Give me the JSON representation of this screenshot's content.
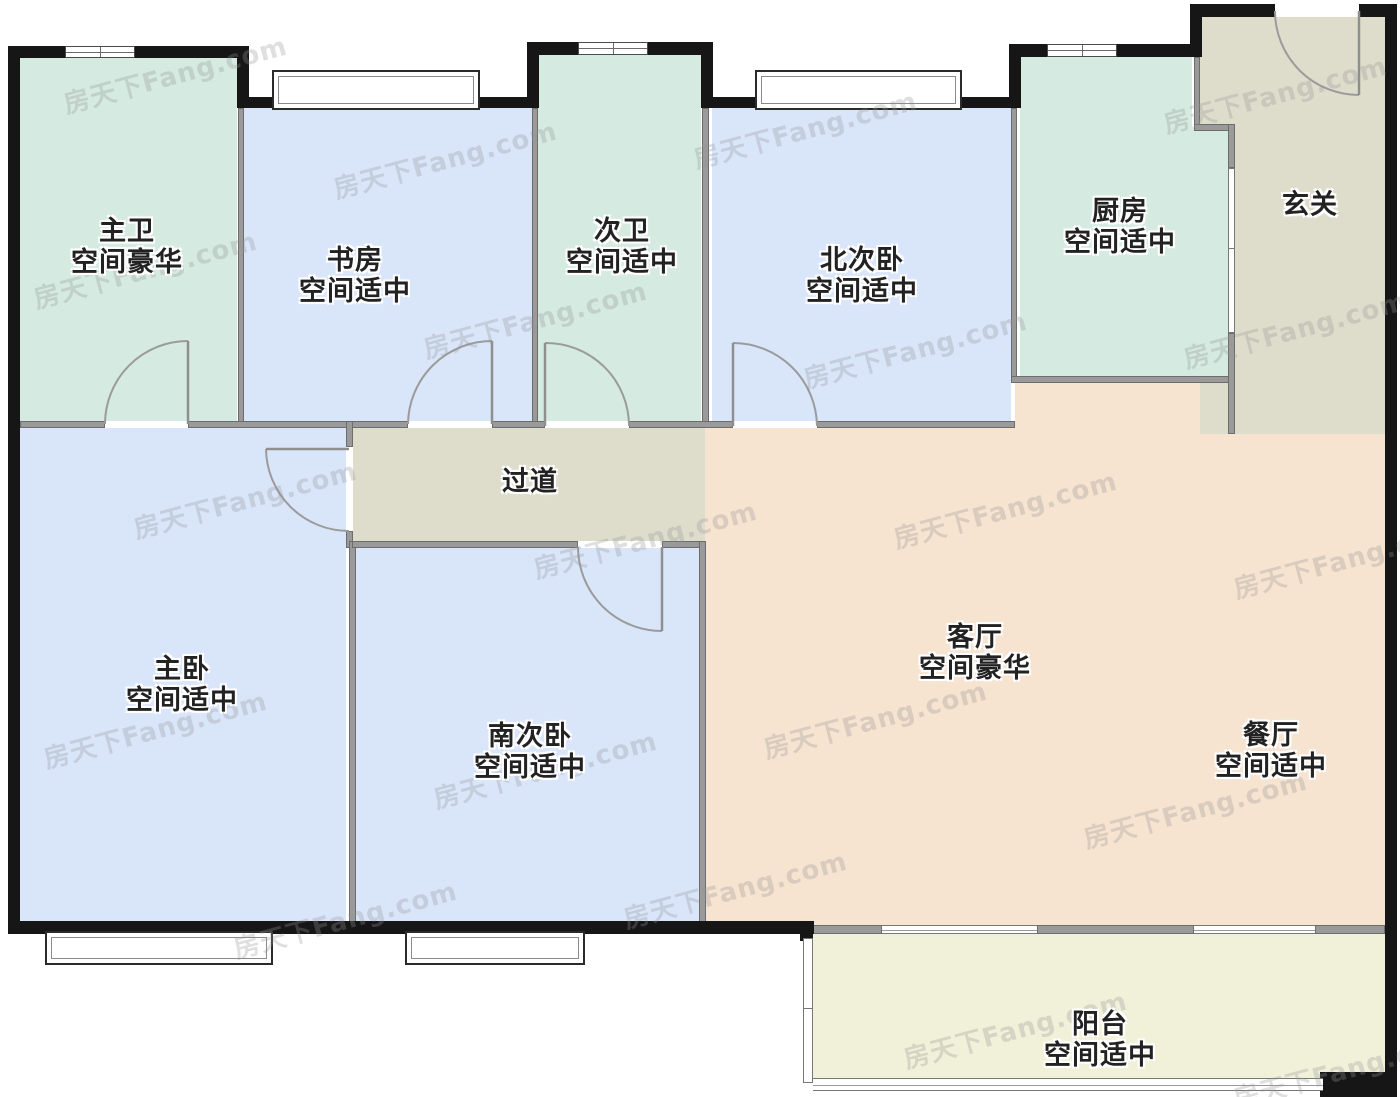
{
  "watermark": {
    "text": "房天下Fang.com"
  },
  "rooms": {
    "zhuwei": {
      "name": "主卫",
      "tag": "空间豪华"
    },
    "shufang": {
      "name": "书房",
      "tag": "空间适中"
    },
    "ciwei": {
      "name": "次卫",
      "tag": "空间适中"
    },
    "beiciwo": {
      "name": "北次卧",
      "tag": "空间适中"
    },
    "chufang": {
      "name": "厨房",
      "tag": "空间适中"
    },
    "xuanguan": {
      "name": "玄关",
      "tag": ""
    },
    "guodao": {
      "name": "过道",
      "tag": ""
    },
    "zhuwo": {
      "name": "主卧",
      "tag": "空间适中"
    },
    "nanciwo": {
      "name": "南次卧",
      "tag": "空间适中"
    },
    "keting": {
      "name": "客厅",
      "tag": "空间豪华"
    },
    "canting": {
      "name": "餐厅",
      "tag": "空间适中"
    },
    "yangtai": {
      "name": "阳台",
      "tag": "空间适中"
    }
  },
  "colors": {
    "outer_wall": "#161616",
    "interior_wall": "#9a9a9a",
    "bath_kitchen_fill": "#d5eae1",
    "bedroom_study_fill": "#d9e5f9",
    "living_dining_fill": "#f6e3d0",
    "hall_entry_fill": "#deddcc",
    "balcony_fill": "#f1f1da"
  }
}
